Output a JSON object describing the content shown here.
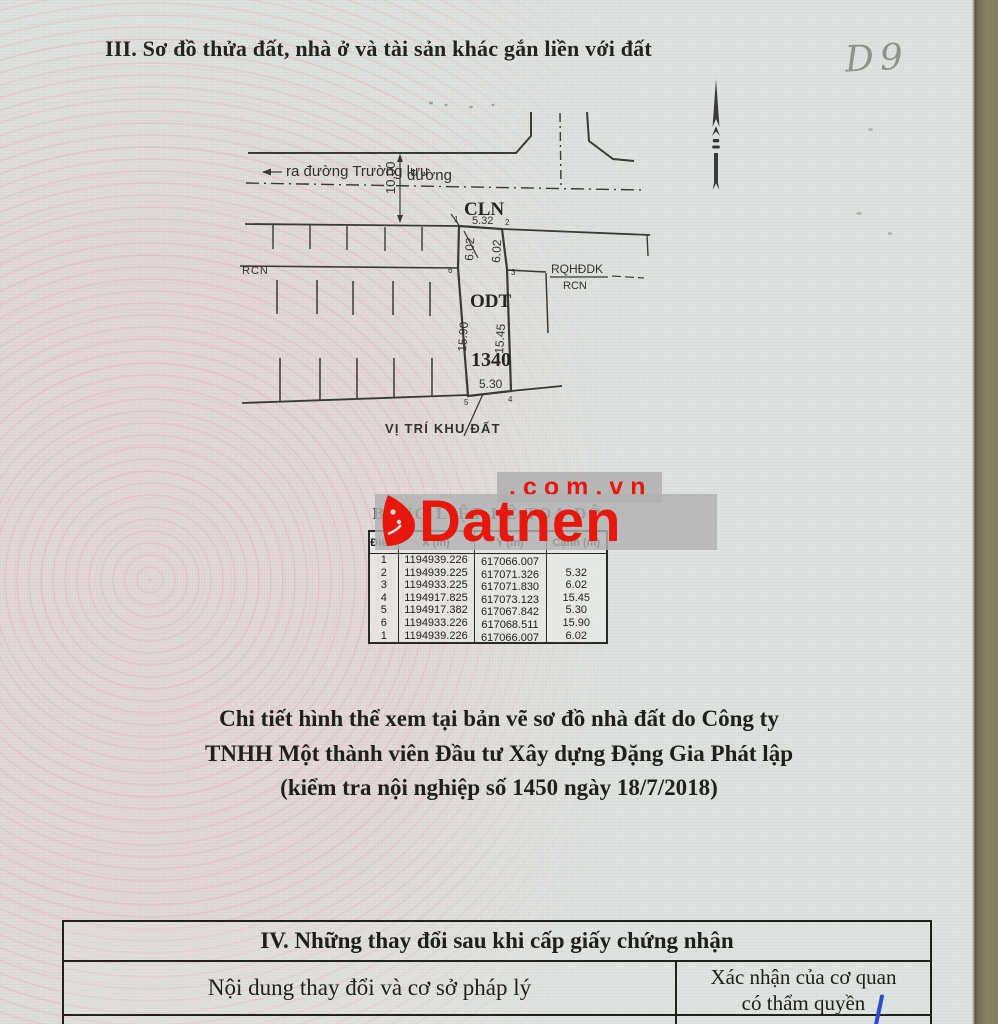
{
  "page": {
    "title": "III. Sơ đồ thửa đất, nhà ở và tài sản khác gắn liền với đất",
    "handwritten_mark": "D9"
  },
  "diagram": {
    "road_exit_label": "ra đường Trường lưu",
    "road_label": "đường",
    "road_width": "10.00",
    "zone_cln": "CLN",
    "zone_odt": "ODT",
    "zone_rcn_left": "RCN",
    "zone_rqhddk": "RQHĐDK",
    "zone_rcn_right": "RCN",
    "plot_number": "1340",
    "location_label": "VỊ TRÍ KHU ĐẤT",
    "edges": {
      "top": "5.32",
      "upper_left": "6.02",
      "upper_right": "6.02",
      "left": "15.90",
      "right": "15.45",
      "bottom": "5.30"
    },
    "points": {
      "p1": "1",
      "p2": "2",
      "p3": "3",
      "p4": "4",
      "p5": "5",
      "p6": "6"
    }
  },
  "watermark": {
    "brand": "Datnen",
    "domain": ".com.vn"
  },
  "coords_table": {
    "title": "BẢNG LIỆT KÊ TOẠ ĐỘ",
    "headers": [
      "Điểm",
      "X (m)",
      "Y (m)",
      "Cạnh (m)"
    ],
    "rows": [
      [
        "1",
        "1194939.226",
        "617066.007",
        ""
      ],
      [
        "2",
        "1194939.225",
        "617071.326",
        "5.32"
      ],
      [
        "3",
        "1194933.225",
        "617071.830",
        "6.02"
      ],
      [
        "4",
        "1194917.825",
        "617073.123",
        "15.45"
      ],
      [
        "5",
        "1194917.382",
        "617067.842",
        "5.30"
      ],
      [
        "6",
        "1194933.226",
        "617068.511",
        "15.90"
      ],
      [
        "1",
        "1194939.226",
        "617066.007",
        "6.02"
      ]
    ]
  },
  "note": {
    "line1": "Chi tiết hình thể xem tại bản vẽ sơ đồ nhà đất do Công ty",
    "line2": "TNHH Một thành viên Đầu tư Xây dựng Đặng Gia Phát lập",
    "line3": "(kiểm tra nội nghiệp số 1450 ngày 18/7/2018)"
  },
  "section_iv": {
    "title": "IV. Những thay đổi sau khi cấp giấy chứng nhận",
    "col_left": "Nội dung thay đổi và cơ sở pháp lý",
    "col_right_line1": "Xác nhận của cơ quan",
    "col_right_line2": "có thẩm quyền"
  },
  "colors": {
    "watermark_red": "#e8170e",
    "paper": "#dfe3e0",
    "page_edge": "#8a8162",
    "ink": "#26261f",
    "pen_blue": "#2b4cc4"
  }
}
